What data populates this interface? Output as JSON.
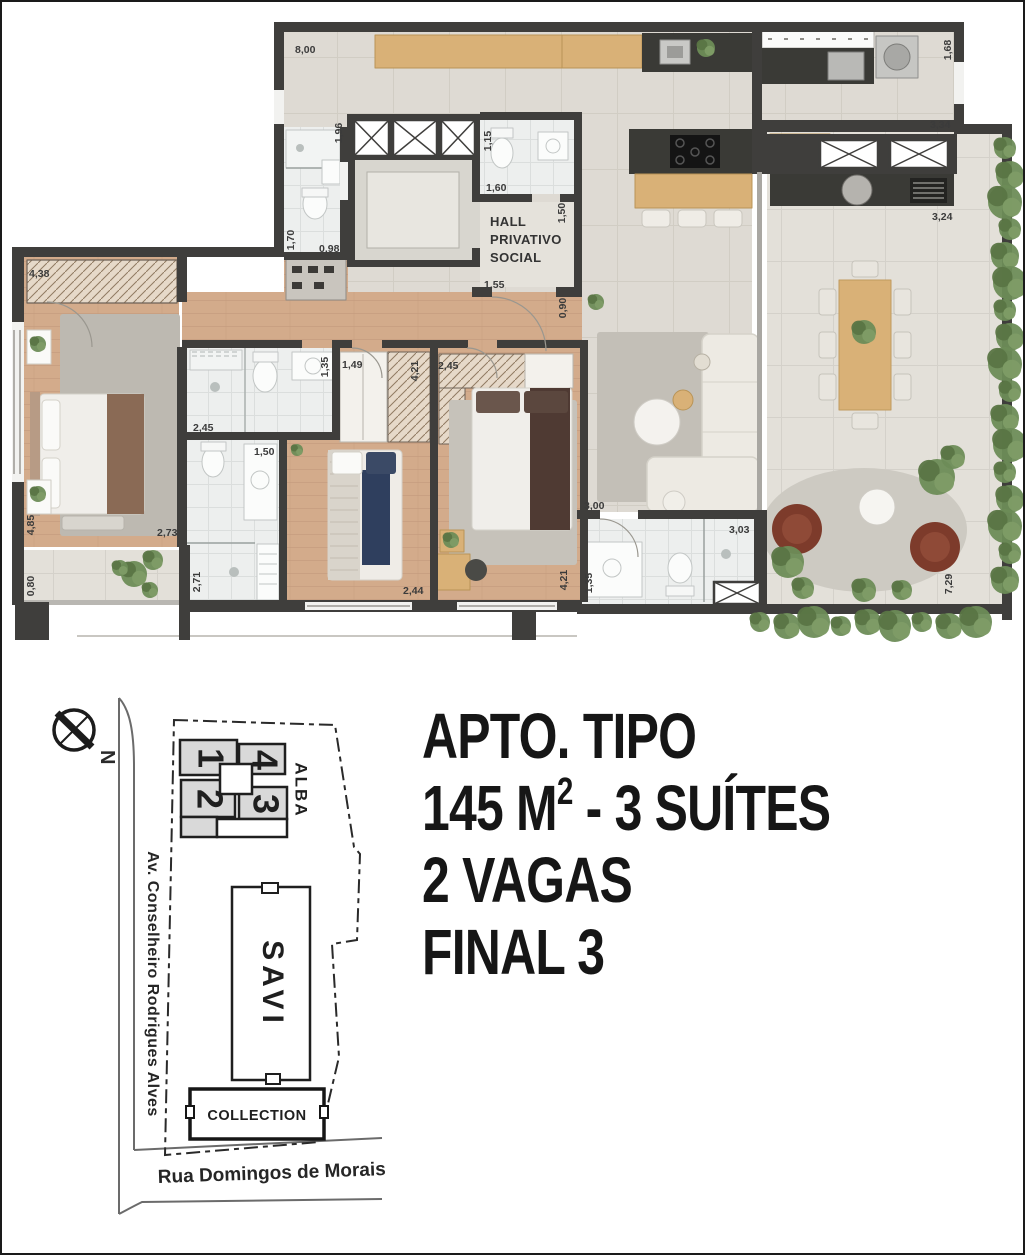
{
  "headline": {
    "line1": "APTO. TIPO",
    "line2_prefix": "145 M",
    "line2_sup": "2",
    "line2_suffix": " - 3 SUÍTES",
    "line3": "2 VAGAS",
    "line4": "FINAL 3"
  },
  "floor_plan": {
    "hall_lines": [
      "HALL",
      "PRIVATIVO",
      "SOCIAL"
    ],
    "dimensions": [
      {
        "t": "8,00",
        "x": 293,
        "y": 51,
        "r": 0
      },
      {
        "t": "1,96",
        "x": 340,
        "y": 131,
        "r": -90
      },
      {
        "t": "1,15",
        "x": 489,
        "y": 139,
        "r": -90
      },
      {
        "t": "1,60",
        "x": 484,
        "y": 189,
        "r": 0
      },
      {
        "t": "1,50",
        "x": 563,
        "y": 211,
        "r": -90
      },
      {
        "t": "1,55",
        "x": 482,
        "y": 286,
        "r": 0
      },
      {
        "t": "1,70",
        "x": 292,
        "y": 238,
        "r": -90
      },
      {
        "t": "0,98",
        "x": 317,
        "y": 250,
        "r": 0
      },
      {
        "t": "1,68",
        "x": 949,
        "y": 48,
        "r": -90
      },
      {
        "t": "3,34",
        "x": 928,
        "y": 126,
        "r": 0
      },
      {
        "t": "3,24",
        "x": 930,
        "y": 218,
        "r": 0
      },
      {
        "t": "4,38",
        "x": 27,
        "y": 275,
        "r": 0
      },
      {
        "t": "0,90",
        "x": 564,
        "y": 306,
        "r": -90
      },
      {
        "t": "1,35",
        "x": 326,
        "y": 365,
        "r": -90
      },
      {
        "t": "1,49",
        "x": 340,
        "y": 366,
        "r": 0
      },
      {
        "t": "4,21",
        "x": 416,
        "y": 369,
        "r": -90
      },
      {
        "t": "2,45",
        "x": 436,
        "y": 367,
        "r": 0
      },
      {
        "t": "2,45",
        "x": 191,
        "y": 429,
        "r": 0
      },
      {
        "t": "1,50",
        "x": 252,
        "y": 453,
        "r": 0
      },
      {
        "t": "3,00",
        "x": 582,
        "y": 507,
        "r": 0
      },
      {
        "t": "3,03",
        "x": 727,
        "y": 531,
        "r": 0
      },
      {
        "t": "2,73",
        "x": 155,
        "y": 534,
        "r": 0
      },
      {
        "t": "4,85",
        "x": 32,
        "y": 523,
        "r": -90
      },
      {
        "t": "0,80",
        "x": 32,
        "y": 584,
        "r": -90
      },
      {
        "t": "2,71",
        "x": 198,
        "y": 580,
        "r": -90
      },
      {
        "t": "2,44",
        "x": 401,
        "y": 592,
        "r": 0
      },
      {
        "t": "4,21",
        "x": 565,
        "y": 578,
        "r": -90
      },
      {
        "t": "1,35",
        "x": 590,
        "y": 581,
        "r": -90
      },
      {
        "t": "7,29",
        "x": 950,
        "y": 582,
        "r": -90
      }
    ]
  },
  "site_plan": {
    "compass_letter": "N",
    "street_left": "Av. Conselheiro Rodrigues Alves",
    "street_bottom": "Rua Domingos de Morais",
    "building_alba": "ALBA",
    "building_savi": "SAVI",
    "building_collection": "COLLECTION",
    "unit_numbers": [
      "1",
      "2",
      "4",
      "3"
    ]
  },
  "colors": {
    "wall": "#3f3e3c",
    "wood_floor": "#d3ab8b",
    "tile_floor": "#dedad3",
    "terrace_floor": "#e3e0d9",
    "bath_floor": "#edefee",
    "counter_dark": "#3a3a36",
    "wood_furniture": "#d9b177",
    "greenery": "#6d8c57",
    "accent_rust": "#96573f",
    "accent_navy": "#2f3f5e",
    "armchair_brown": "#7d3b2b",
    "headline_ink": "#161616"
  }
}
